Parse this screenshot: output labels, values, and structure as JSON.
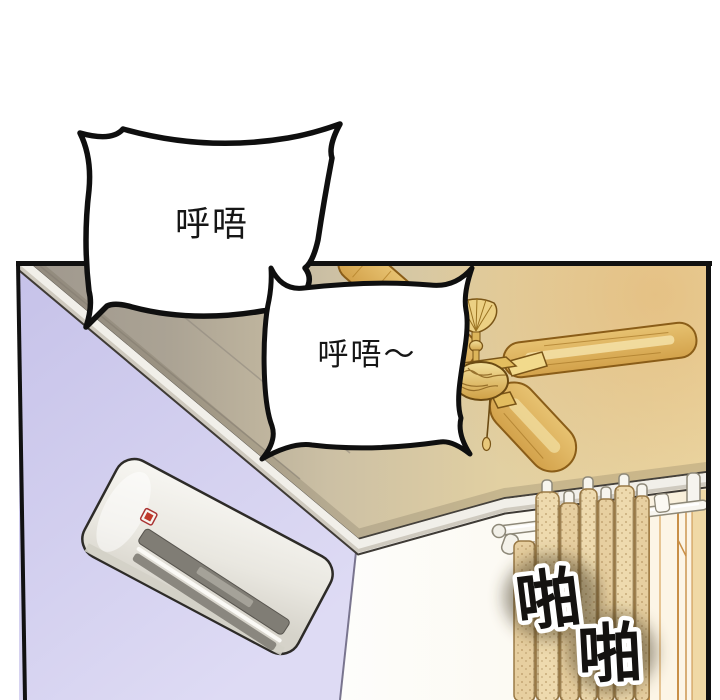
{
  "page": {
    "type": "webtoon-comic-panel",
    "background": "#ffffff"
  },
  "speech_bubbles": [
    {
      "id": 1,
      "text": "呼唔",
      "style": "burst"
    },
    {
      "id": 2,
      "text": "呼唔～",
      "style": "burst"
    }
  ],
  "sfx": [
    {
      "id": 1,
      "text": "啪"
    },
    {
      "id": 2,
      "text": "啪"
    }
  ],
  "scene": {
    "objects": [
      "ceiling-fan",
      "air-conditioner",
      "crown-molding",
      "curtain-rod",
      "curtains",
      "window-frame",
      "left-wall",
      "ceiling"
    ],
    "colors": {
      "panel_border": "#111111",
      "ceiling_left_gray": "#9e978d",
      "ceiling_right_tan": "#ebd8a6",
      "ceiling_glow": "#e2b06a",
      "wall_left_lavender": "#cfcbf0",
      "wall_right_white": "#fdfdfb",
      "fan_gold": "#dfb25f",
      "curtain_beige": "#eedaae",
      "ac_body": "#efeee8",
      "ac_badge_red": "#c0392b",
      "sfx_fill": "#141210",
      "sfx_outline": "#ffffff"
    }
  }
}
